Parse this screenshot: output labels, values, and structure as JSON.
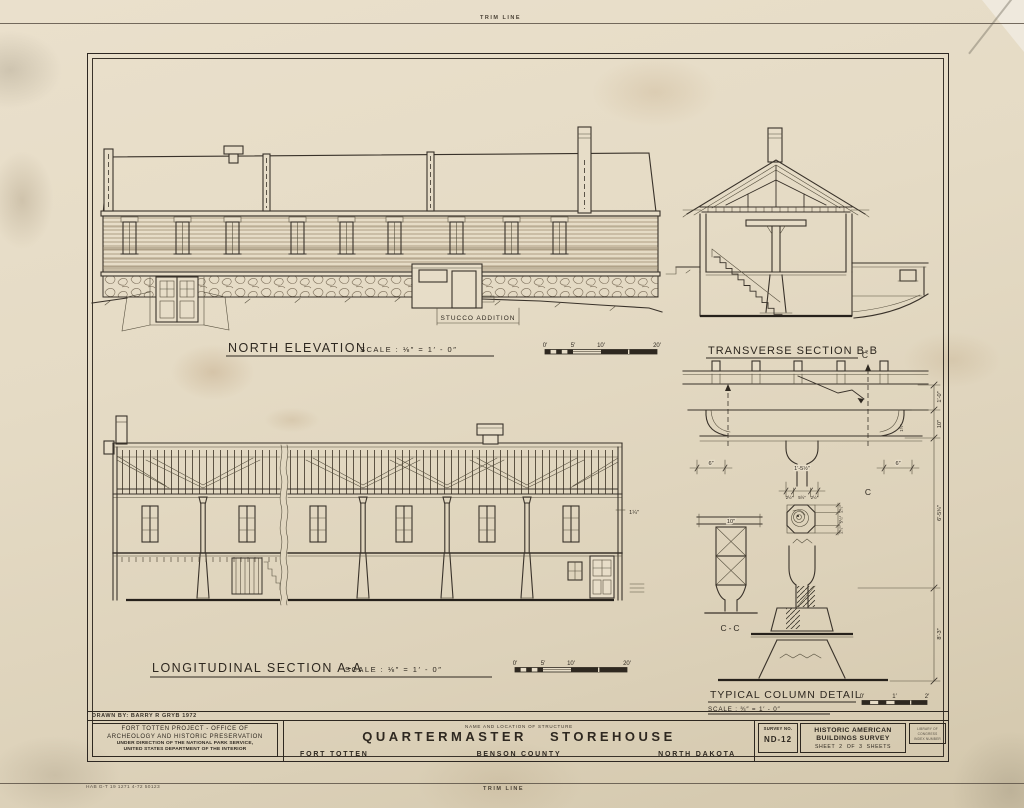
{
  "page": {
    "trim_top": "TRIM LINE",
    "trim_bottom": "TRIM LINE",
    "print_code": "HAB G-T 19 1271 4-72 50123"
  },
  "drawings": {
    "north_elevation": {
      "title": "NORTH ELEVATION",
      "scale_text": "SCALE   :   ⅛″  =  1′ - 0″",
      "annotation": "STUCCO ADDITION",
      "ticks": [
        "0′",
        "5′",
        "10′",
        "20′"
      ]
    },
    "transverse_section": {
      "title": "TRANSVERSE  SECTION  B-B"
    },
    "longitudinal_section": {
      "title": "LONGITUDINAL  SECTION  A-A",
      "scale_text": "SCALE   :   ⅛″  =  1′ - 0″",
      "ticks": [
        "0′",
        "5′",
        "10′",
        "20′"
      ],
      "dim_right": "1¼″"
    },
    "column_detail": {
      "title": "TYPICAL  COLUMN  DETAIL",
      "scale_text": "SCALE  :  ¾″  =  1′ - 0″",
      "ticks": [
        "0′",
        "1′",
        "2′"
      ],
      "cut_mark_top": "C",
      "cut_mark_bottom": "C",
      "section_label": "C-C",
      "dims": {
        "chain_1": "1′-0″",
        "chain_2": "10″",
        "chain_3": "6′-5¾″",
        "chain_4": "8′-3″",
        "six_left": "6″",
        "six_right": "6″",
        "cap_width": "1′-5½″",
        "cap_row": [
          "2½″",
          "5½″",
          "2½″"
        ],
        "bracket": "1½″",
        "cc_width": "10″",
        "oct": [
          "2½″",
          "5½″",
          "2½″"
        ]
      }
    }
  },
  "title_block": {
    "drawn_by": "DRAWN BY:  BARRY R  GRYB  1972",
    "project_lines": [
      "FORT  TOTTEN   PROJECT  -  OFFICE   OF",
      "ARCHEOLOGY   AND   HISTORIC   PRESERVATION",
      "UNDER DIRECTION OF THE NATIONAL PARK SERVICE,",
      "UNITED STATES DEPARTMENT OF THE INTERIOR"
    ],
    "name_caption": "NAME AND LOCATION OF STRUCTURE",
    "structure_name": "QUARTERMASTER  STOREHOUSE",
    "location_left": "FORT  TOTTEN",
    "location_center": "BENSON  COUNTY",
    "location_right": "NORTH  DAKOTA",
    "survey_caption": "SURVEY NO.",
    "survey_no": "ND-12",
    "habs_line1": "HISTORIC AMERICAN",
    "habs_line2": "BUILDINGS SURVEY",
    "sheet_line": "SHEET  2  OF  3  SHEETS",
    "loc_line1": "LIBRARY OF CONGRESS",
    "loc_line2": "INDEX NUMBER"
  }
}
